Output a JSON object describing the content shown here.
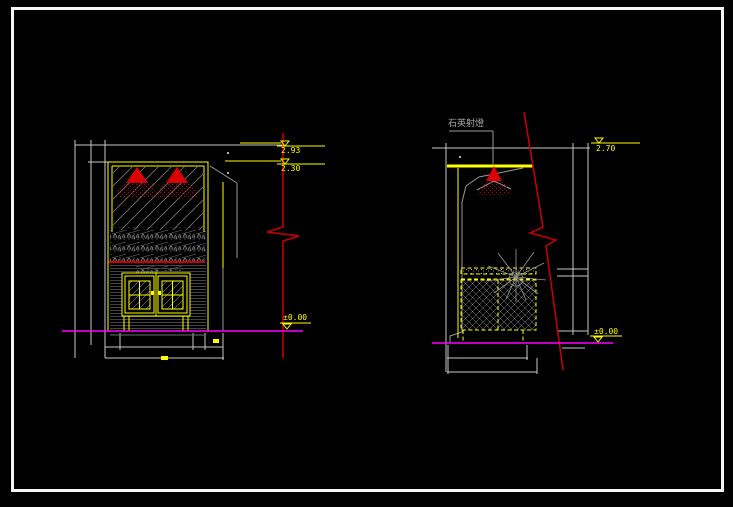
{
  "app": {
    "background": "#000000",
    "frame_color": "#f5f5f5"
  },
  "colors": {
    "accent_yellow": "#ffff00",
    "light_red": "#dd0000",
    "ground_magenta": "#ff00ff",
    "dimension_gray": "#c8c8c8",
    "detail_gray": "#999999"
  },
  "left_view": {
    "level_top": "2.93",
    "level_mid": "2.30",
    "level_ground": "±0.00"
  },
  "right_view": {
    "fixture_label": "石英射燈",
    "level_top": "2.70",
    "level_ground": "±0.00"
  }
}
